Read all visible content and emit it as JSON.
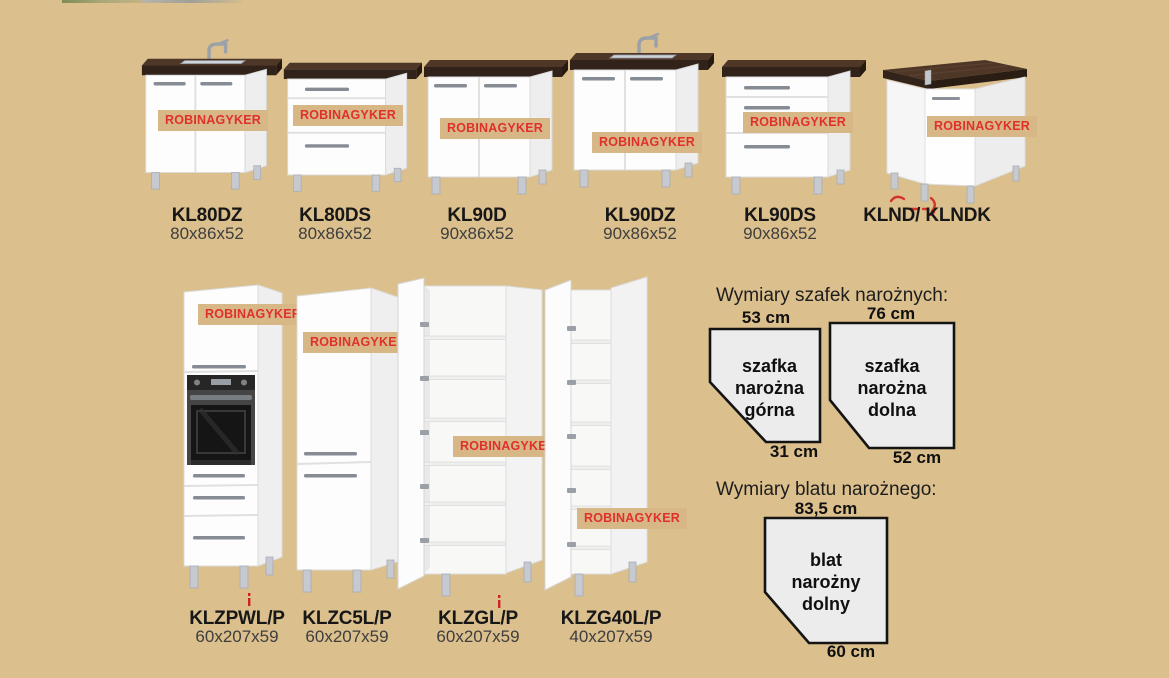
{
  "watermark": {
    "text": "ROBINAGYKER"
  },
  "colors": {
    "page_bg": "#DBBF8D",
    "wm_bg": "#D8B787",
    "wm_text": "#E0302A",
    "counter_front": "#32231A",
    "counter_top": "#4E3727",
    "diagram_fill": "#ECECEC",
    "diagram_border": "#141414"
  },
  "products_top": [
    {
      "name": "KL80DZ",
      "dims": "80x86x52"
    },
    {
      "name": "KL80DS",
      "dims": "80x86x52"
    },
    {
      "name": "KL90D",
      "dims": "90x86x52"
    },
    {
      "name": "KL90DZ",
      "dims": "90x86x52"
    },
    {
      "name": "KL90DS",
      "dims": "90x86x52"
    },
    {
      "name": "KLND/ KLNDK",
      "dims": ""
    }
  ],
  "products_bottom": [
    {
      "name": "KLZPWL/P",
      "dims": "60x207x59"
    },
    {
      "name": "KLZC5L/P",
      "dims": "60x207x59"
    },
    {
      "name": "KLZGL/P",
      "dims": "60x207x59"
    },
    {
      "name": "KLZG40L/P",
      "dims": "40x207x59"
    }
  ],
  "diagrams": {
    "title_cabinets": "Wymiary szafek narożnych:",
    "title_worktop": "Wymiary blatu narożnego:",
    "upper_corner": {
      "top_dim": "53 cm",
      "bottom_dim": "31 cm",
      "lines": [
        "szafka",
        "narożna",
        "górna"
      ]
    },
    "lower_corner": {
      "top_dim": "76 cm",
      "bottom_dim": "52 cm",
      "lines": [
        "szafka",
        "narożna",
        "dolna"
      ]
    },
    "worktop": {
      "top_dim": "83,5 cm",
      "bottom_dim": "60 cm",
      "lines": [
        "blat",
        "narożny",
        "dolny"
      ]
    }
  }
}
